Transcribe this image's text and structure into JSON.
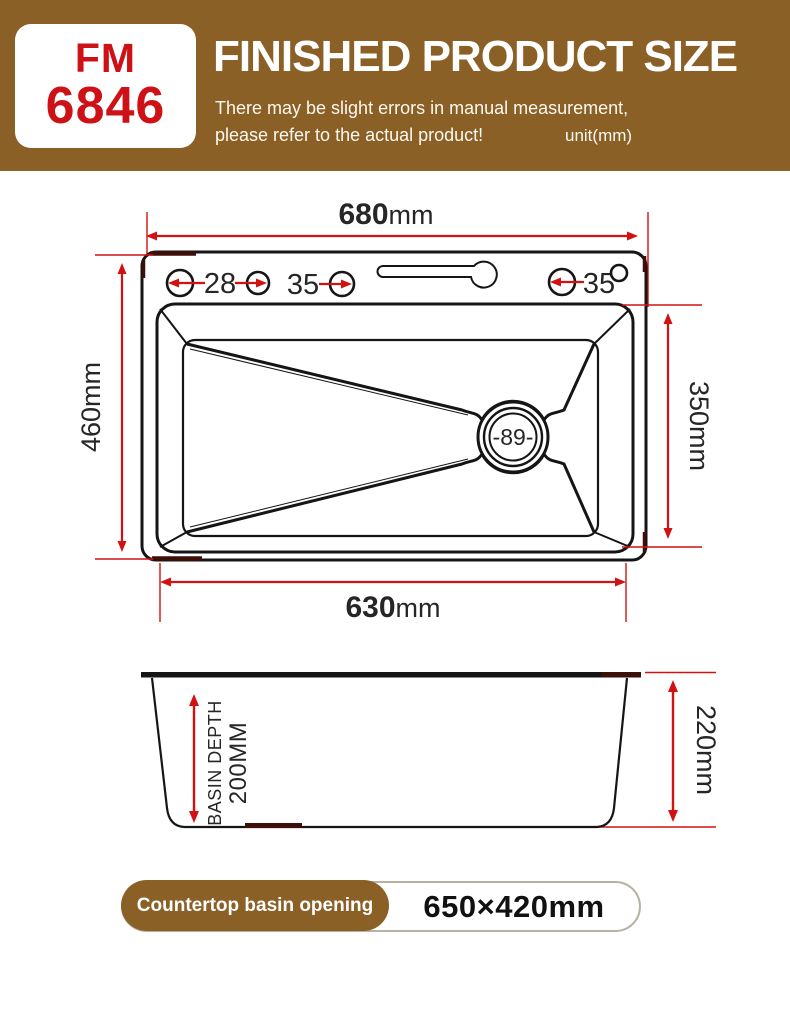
{
  "header": {
    "model_line1": "FM",
    "model_line2": "6846",
    "title": "FINISHED PRODUCT SIZE",
    "note_line1": "There may be slight errors in manual measurement,",
    "note_line2": "please refer to the actual product!",
    "unit": "unit(mm)"
  },
  "top_view": {
    "width_value": "680",
    "width_unit": "mm",
    "left_dim": "460mm",
    "right_dim": "350mm",
    "bottom_value": "630",
    "bottom_unit": "mm",
    "hole1": "28",
    "hole2": "35",
    "hole3": "35",
    "drain": "-89-"
  },
  "side_view": {
    "depth_line1": "BASIN DEPTH",
    "depth_line2": "200MM",
    "height": "220mm"
  },
  "footer": {
    "label": "Countertop basin opening",
    "size": "650×420mm"
  },
  "colors": {
    "brand_brown": "#8A6026",
    "model_red": "#CE1117",
    "dimension_red": "#D21212",
    "line_black": "#151515",
    "corner_maroon": "#3E0E08"
  }
}
